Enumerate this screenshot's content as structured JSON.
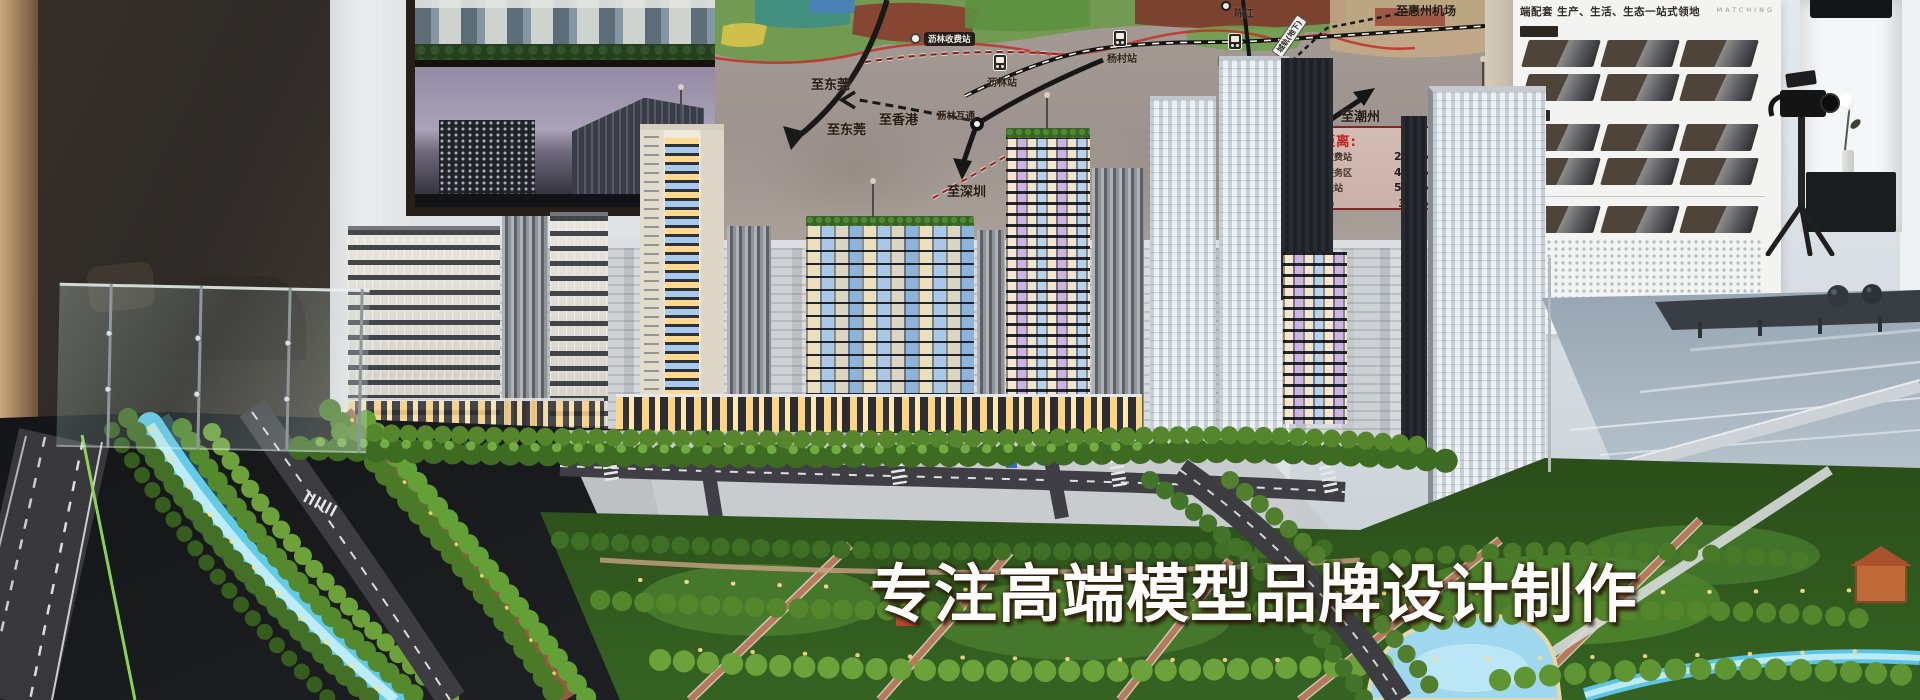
{
  "slogan": {
    "text": "专注高端模型品牌设计制作"
  },
  "map_board": {
    "destinations": [
      {
        "text": "至东莞"
      },
      {
        "text": "至东莞"
      },
      {
        "text": "至香港"
      },
      {
        "text": "至深圳"
      },
      {
        "text": "至潮州"
      },
      {
        "text": "至惠州机场"
      }
    ],
    "stations": [
      {
        "text": "沥林收费站"
      },
      {
        "text": "沥林站"
      },
      {
        "text": "杨村站"
      },
      {
        "text": "陈江"
      },
      {
        "text": "陈江南站"
      },
      {
        "text": "镇隆互通"
      },
      {
        "text": "沥林互通"
      }
    ],
    "rail_label": "城轨(地下)",
    "distance_panel": {
      "title": "目距离:",
      "rows": [
        {
          "place": "三和收费站",
          "distance": "2.7KM"
        },
        {
          "place": "恺北服务区",
          "distance": "4.6KM"
        },
        {
          "place": "南高铁站",
          "distance": "5.5KM"
        },
        {
          "place": "州机场",
          "distance": "35KM"
        }
      ]
    }
  },
  "right_board": {
    "header": "端配套 生产、生活、生态一站式领地",
    "watermark": "MATCHING"
  },
  "colors": {
    "river_glow": "#62cbe8",
    "distance_red": "#c1231e",
    "slogan_white": "#fdfdfb",
    "tree_green": "#55862c"
  },
  "icons": {
    "station": "train-icon",
    "interchange": "junction-ring-icon",
    "toll": "toll-station-icon",
    "camera": "video-camera-icon",
    "flower": "flower-vase-icon"
  }
}
